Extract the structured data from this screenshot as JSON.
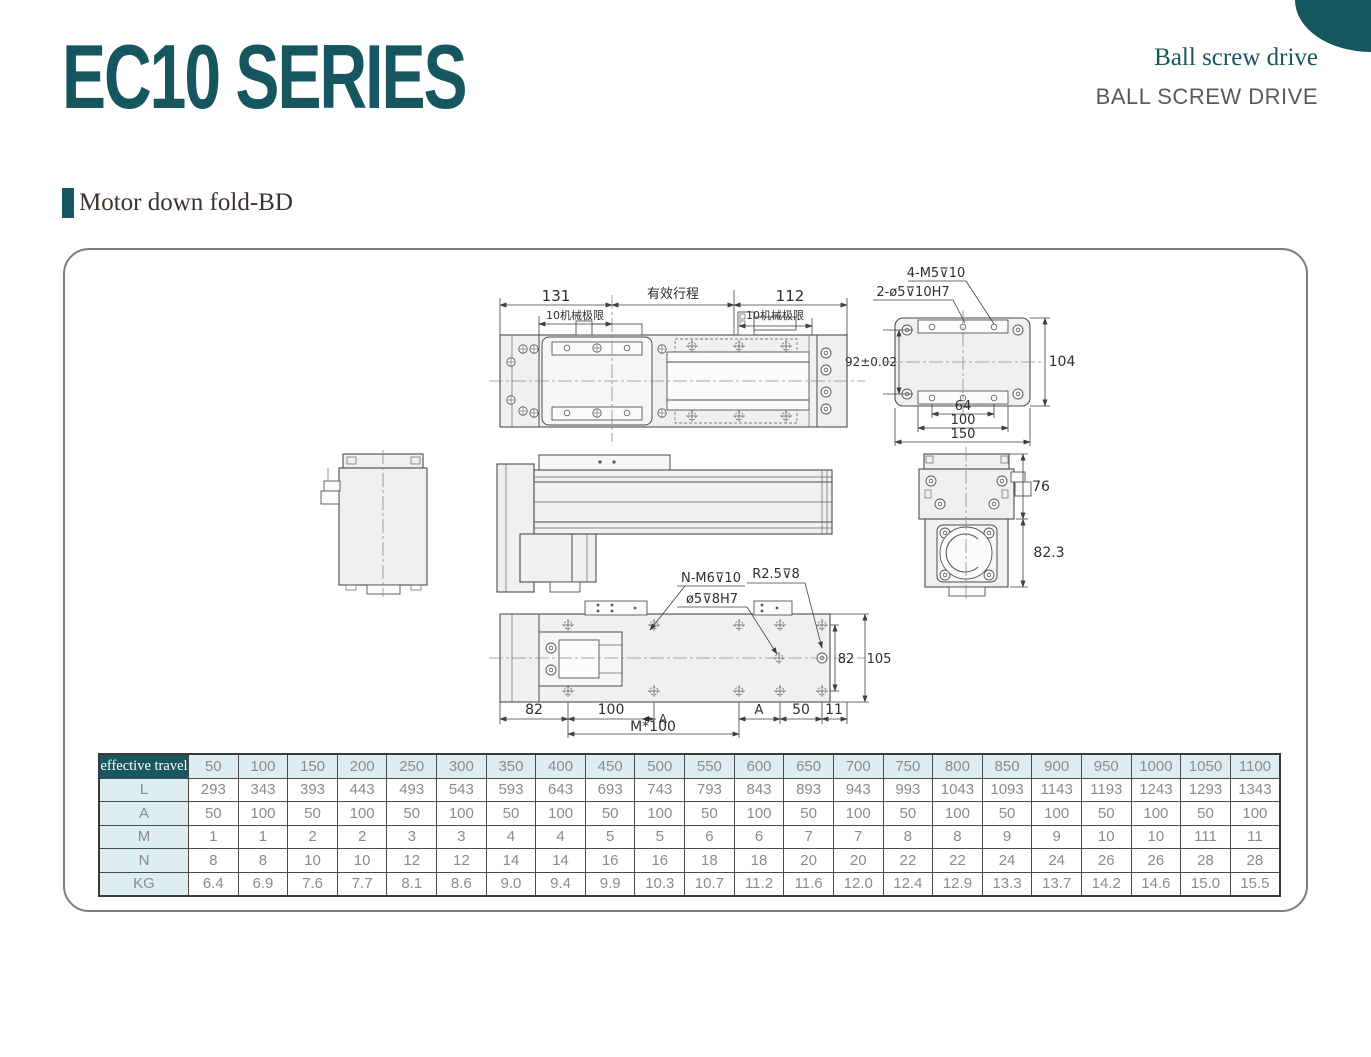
{
  "header": {
    "series_title": "EC10 SERIES",
    "subtitle": "Ball screw drive",
    "subtitle_caps": "BALL SCREW DRIVE"
  },
  "section": {
    "title": "Motor down fold-BD"
  },
  "colors": {
    "accent": "#16565e",
    "table_header_bg": "#19565e",
    "table_light_bg": "#deedf2",
    "table_text": "#8b8b8b"
  },
  "table": {
    "header_label": "effective travel",
    "columns": [
      "50",
      "100",
      "150",
      "200",
      "250",
      "300",
      "350",
      "400",
      "450",
      "500",
      "550",
      "600",
      "650",
      "700",
      "750",
      "800",
      "850",
      "900",
      "950",
      "1000",
      "1050",
      "1100"
    ],
    "rows": [
      {
        "label": "L",
        "values": [
          "293",
          "343",
          "393",
          "443",
          "493",
          "543",
          "593",
          "643",
          "693",
          "743",
          "793",
          "843",
          "893",
          "943",
          "993",
          "1043",
          "1093",
          "1143",
          "1193",
          "1243",
          "1293",
          "1343"
        ]
      },
      {
        "label": "A",
        "values": [
          "50",
          "100",
          "50",
          "100",
          "50",
          "100",
          "50",
          "100",
          "50",
          "100",
          "50",
          "100",
          "50",
          "100",
          "50",
          "100",
          "50",
          "100",
          "50",
          "100",
          "50",
          "100"
        ]
      },
      {
        "label": "M",
        "values": [
          "1",
          "1",
          "2",
          "2",
          "3",
          "3",
          "4",
          "4",
          "5",
          "5",
          "6",
          "6",
          "7",
          "7",
          "8",
          "8",
          "9",
          "9",
          "10",
          "10",
          "111",
          "11"
        ]
      },
      {
        "label": "N",
        "values": [
          "8",
          "8",
          "10",
          "10",
          "12",
          "12",
          "14",
          "14",
          "16",
          "16",
          "18",
          "18",
          "20",
          "20",
          "22",
          "22",
          "24",
          "24",
          "26",
          "26",
          "28",
          "28"
        ]
      },
      {
        "label": "KG",
        "values": [
          "6.4",
          "6.9",
          "7.6",
          "7.7",
          "8.1",
          "8.6",
          "9.0",
          "9.4",
          "9.9",
          "10.3",
          "10.7",
          "11.2",
          "11.6",
          "12.0",
          "12.4",
          "12.9",
          "13.3",
          "13.7",
          "14.2",
          "14.6",
          "15.0",
          "15.5"
        ]
      }
    ]
  },
  "drawing": {
    "labels": [
      {
        "t": "131",
        "x": 491,
        "y": 51,
        "s": 15
      },
      {
        "t": "有效行程",
        "x": 608,
        "y": 48,
        "s": 13
      },
      {
        "t": "112",
        "x": 725,
        "y": 51,
        "s": 15
      },
      {
        "t": "10机械极限",
        "x": 510,
        "y": 69,
        "s": 11
      },
      {
        "t": "10机械极限",
        "x": 710,
        "y": 69,
        "s": 11
      },
      {
        "t": "4-M5⊽10",
        "x": 871,
        "y": 27,
        "s": 13
      },
      {
        "t": "2-ø5⊽10H7",
        "x": 848,
        "y": 46,
        "s": 13
      },
      {
        "t": "92±0.02",
        "x": 806,
        "y": 116,
        "s": 12
      },
      {
        "t": "104",
        "x": 997,
        "y": 116,
        "s": 14
      },
      {
        "t": "64",
        "x": 898,
        "y": 160,
        "s": 13
      },
      {
        "t": "100",
        "x": 898,
        "y": 174,
        "s": 13
      },
      {
        "t": "150",
        "x": 898,
        "y": 188,
        "s": 13
      },
      {
        "t": "76",
        "x": 976,
        "y": 241,
        "s": 14
      },
      {
        "t": "82.3",
        "x": 984,
        "y": 307,
        "s": 14
      },
      {
        "t": "N-M6⊽10",
        "x": 646,
        "y": 332,
        "s": 13
      },
      {
        "t": "R2.5⊽8",
        "x": 711,
        "y": 328,
        "s": 13
      },
      {
        "t": "ø5⊽8H7",
        "x": 647,
        "y": 353,
        "s": 13
      },
      {
        "t": "82",
        "x": 781,
        "y": 413,
        "s": 13
      },
      {
        "t": "105",
        "x": 814,
        "y": 413,
        "s": 13
      },
      {
        "t": "82",
        "x": 469,
        "y": 464,
        "s": 14
      },
      {
        "t": "100",
        "x": 546,
        "y": 464,
        "s": 14
      },
      {
        "t": "A",
        "x": 598,
        "y": 473,
        "s": 12
      },
      {
        "t": "M*100",
        "x": 588,
        "y": 481,
        "s": 14
      },
      {
        "t": "A",
        "x": 694,
        "y": 464,
        "s": 13
      },
      {
        "t": "50",
        "x": 736,
        "y": 464,
        "s": 14
      },
      {
        "t": "11",
        "x": 769,
        "y": 464,
        "s": 14
      }
    ]
  }
}
